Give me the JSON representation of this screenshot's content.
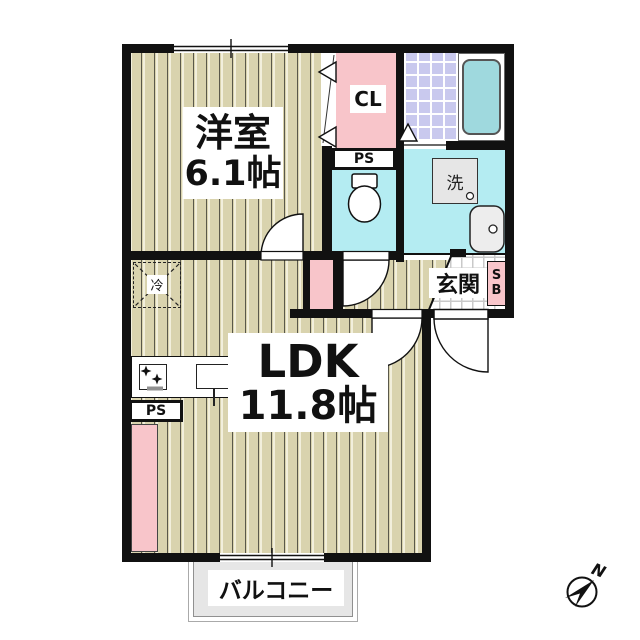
{
  "rooms": {
    "western_room": {
      "name": "洋室",
      "size": "6.1帖"
    },
    "ldk": {
      "name": "LDK",
      "size": "11.8帖"
    },
    "closet": {
      "label": "CL"
    },
    "entrance": {
      "label": "玄関"
    },
    "balcony": {
      "label": "バルコニー"
    }
  },
  "fixtures": {
    "pipe_space_toilet": {
      "label": "PS"
    },
    "pipe_space_kitchen": {
      "label": "PS"
    },
    "washing_machine": {
      "label": "洗"
    },
    "refrigerator": {
      "label": "冷"
    },
    "shoe_box": {
      "line1": "S",
      "line2": "B"
    }
  },
  "compass": {
    "north": "N"
  },
  "colors": {
    "wall": "#111111",
    "wood_floor": "#d9d3ae",
    "pink": "#f8c5ca",
    "water_cyan": "#b4ecf2",
    "bath_tile": "#c9c9ee",
    "bathtub": "#9fd9de",
    "balcony_fill": "#e6e6e6"
  }
}
